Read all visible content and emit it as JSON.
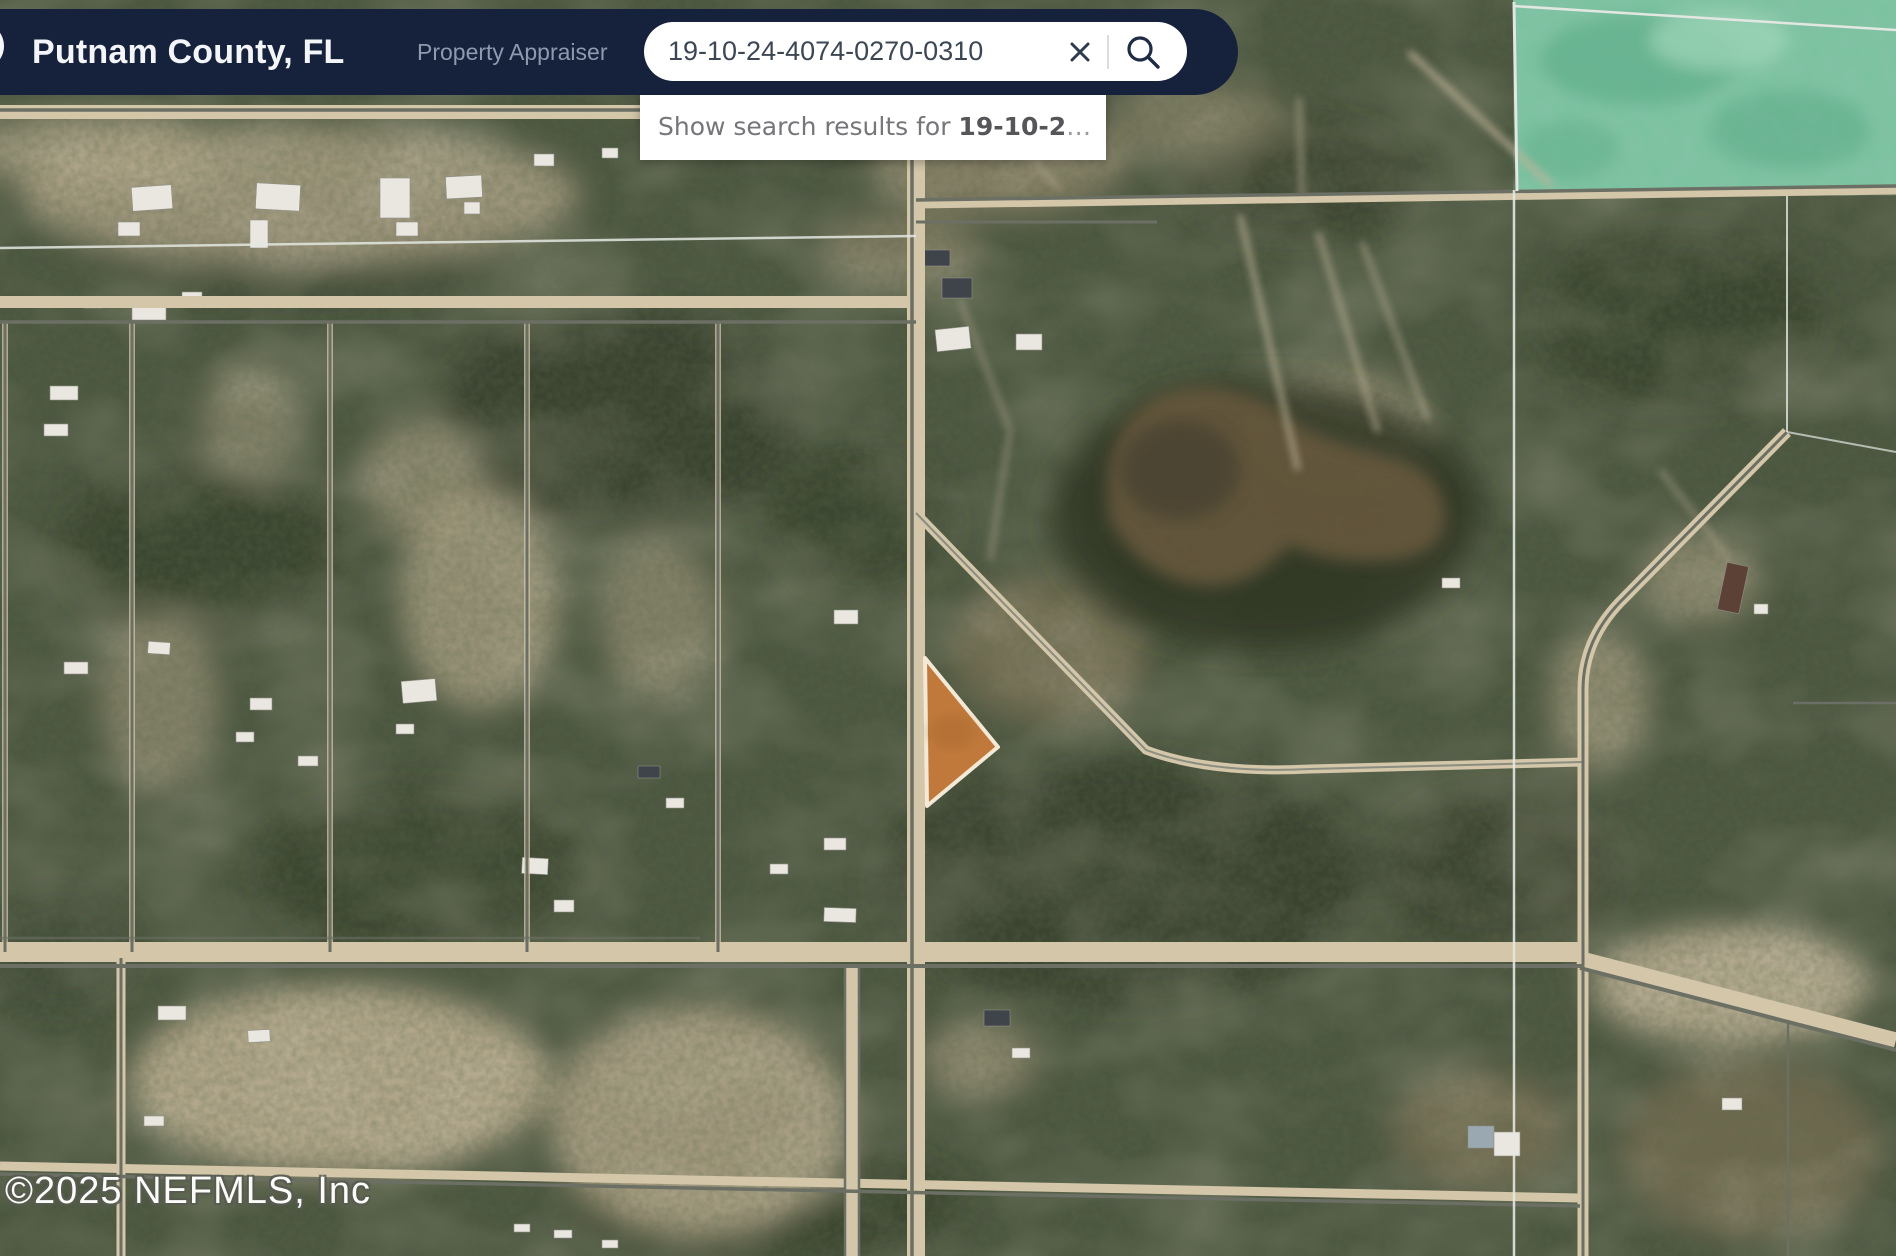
{
  "header": {
    "title": "Putnam County, FL",
    "subtitle": "Property Appraiser",
    "bar_color": "#16223c",
    "search": {
      "value": "19-10-24-4074-0270-0310",
      "clear_icon": "x-close",
      "search_icon": "magnifying-glass"
    }
  },
  "suggestion": {
    "prefix": "Show search results for ",
    "query_bold": "19-10-2",
    "ellipsis": "…"
  },
  "map": {
    "type": "satellite-aerial",
    "attribution": "©2025 NEFMLS, Inc",
    "highlighted_parcel_color": "#c0793b",
    "overlay_region_color": "#7cc2a1",
    "road_line_color": "#6b6f64",
    "section_line_color": "#e3e7e2"
  }
}
